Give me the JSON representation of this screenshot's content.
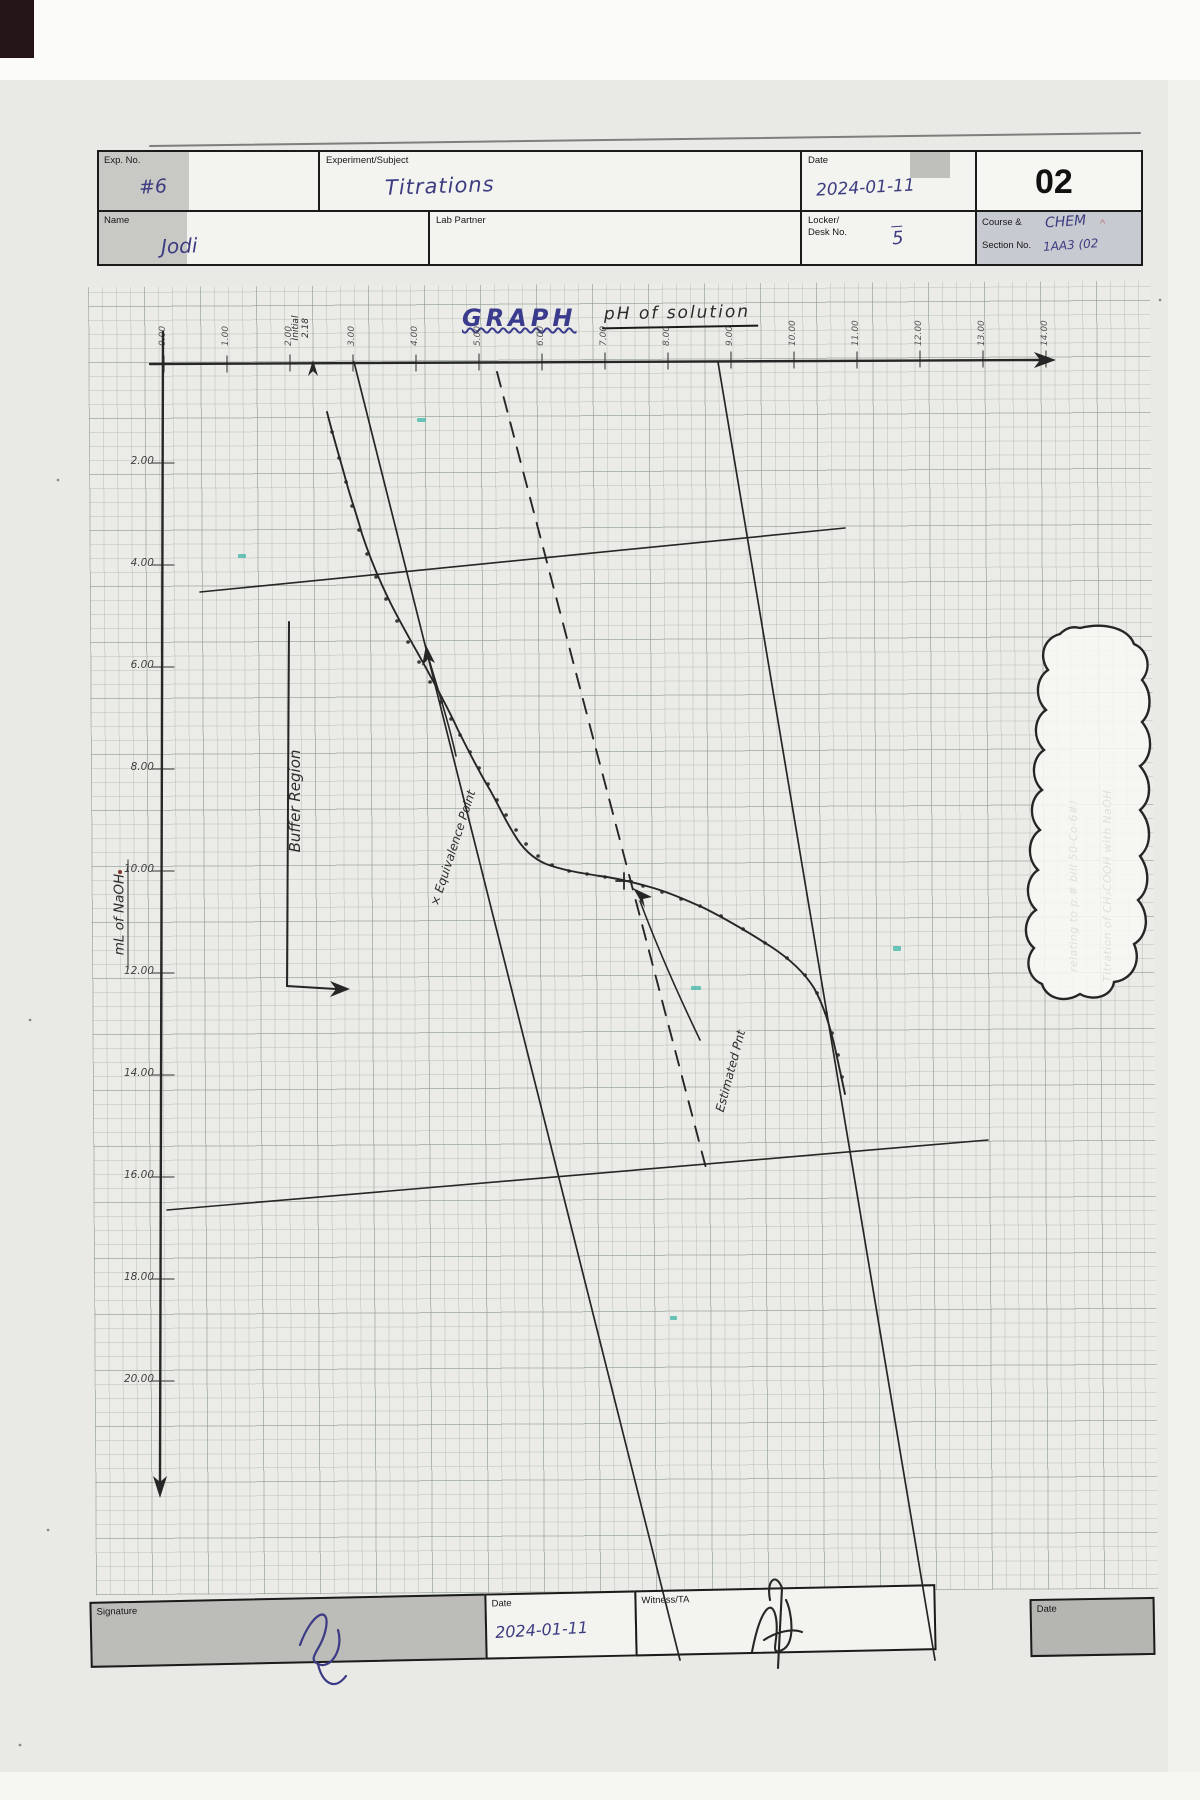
{
  "page": {
    "number": "02"
  },
  "colors": {
    "ink_blue": "#3c3c80",
    "ink_dark": "#2b2b2b",
    "highlight_teal": "#49b8ad",
    "paper": "#ebebe7"
  },
  "header": {
    "exp_no": {
      "label": "Exp. No.",
      "value": "#6"
    },
    "subject": {
      "label": "Experiment/Subject",
      "value": "Titrations"
    },
    "date": {
      "label": "Date",
      "value": "2024-01-11"
    },
    "name": {
      "label": "Name",
      "value": "Jodi"
    },
    "lab_partner": {
      "label": "Lab Partner",
      "value": ""
    },
    "locker": {
      "label1": "Locker/",
      "label2": "Desk No.",
      "value": "5"
    },
    "course": {
      "label1": "Course &",
      "label2": "Section No.",
      "value1": "CHEM",
      "value2": "1AA3 (02"
    }
  },
  "graph": {
    "title": "GRAPH",
    "subtitle": "pH of solution",
    "y_axis_label": "mL of NaOH",
    "x_ticks": [
      "0.00",
      "1.00",
      "2.00",
      "3.00",
      "4.00",
      "5.00",
      "6.00",
      "7.00",
      "8.00",
      "9.00",
      "10.00",
      "11.00",
      "12.00",
      "13.00",
      "14.00"
    ],
    "y_ticks": [
      "2.00",
      "4.00",
      "6.00",
      "8.00",
      "10.00",
      "12.00",
      "14.00",
      "16.00",
      "18.00",
      "20.00"
    ],
    "annotations": {
      "initial_line1": "Initial",
      "initial_line2": "2.18",
      "buffer": "Buffer Region",
      "equivalence": "× Equivalence Point",
      "estimated": "Estimated Pnt"
    },
    "note_cloud": {
      "line1": "Titration of CH₃COOH with NaOH",
      "line2": "relating to p.# bill 50-Co-6#!"
    }
  },
  "footer": {
    "signature": {
      "label": "Signature"
    },
    "date": {
      "label": "Date",
      "value": "2024-01-11"
    },
    "witness": {
      "label": "Witness/TA"
    },
    "date2": {
      "label": "Date"
    }
  },
  "chart_data": {
    "type": "line",
    "title": "pH of solution (titration curve, hand-drawn)",
    "xlabel": "pH of solution",
    "ylabel": "mL of NaOH",
    "xlim": [
      0,
      14
    ],
    "ylim": [
      0,
      20
    ],
    "layout_note": "pH on horizontal axis along top edge; volume of NaOH increases downward on left axis",
    "series": [
      {
        "name": "pH vs mL NaOH",
        "points_pH_mL": [
          [
            2.2,
            0
          ],
          [
            2.4,
            1
          ],
          [
            2.6,
            2
          ],
          [
            2.9,
            3
          ],
          [
            3.1,
            4
          ],
          [
            3.4,
            5
          ],
          [
            3.7,
            6
          ],
          [
            4.0,
            7
          ],
          [
            4.4,
            8
          ],
          [
            4.9,
            9
          ],
          [
            5.6,
            9.7
          ],
          [
            6.5,
            10.0
          ],
          [
            7.5,
            10.1
          ],
          [
            8.5,
            10.3
          ],
          [
            9.4,
            10.6
          ],
          [
            10.2,
            11.2
          ],
          [
            10.8,
            12.2
          ],
          [
            11.2,
            13.5
          ],
          [
            11.5,
            15.0
          ]
        ]
      }
    ],
    "annotations": [
      "Initial pH 2.18",
      "Buffer Region bracket",
      "Equivalence Point marked on curve",
      "Estimated Pnt on dashed reference line",
      "two straight reference lines drawn across the grid"
    ]
  }
}
